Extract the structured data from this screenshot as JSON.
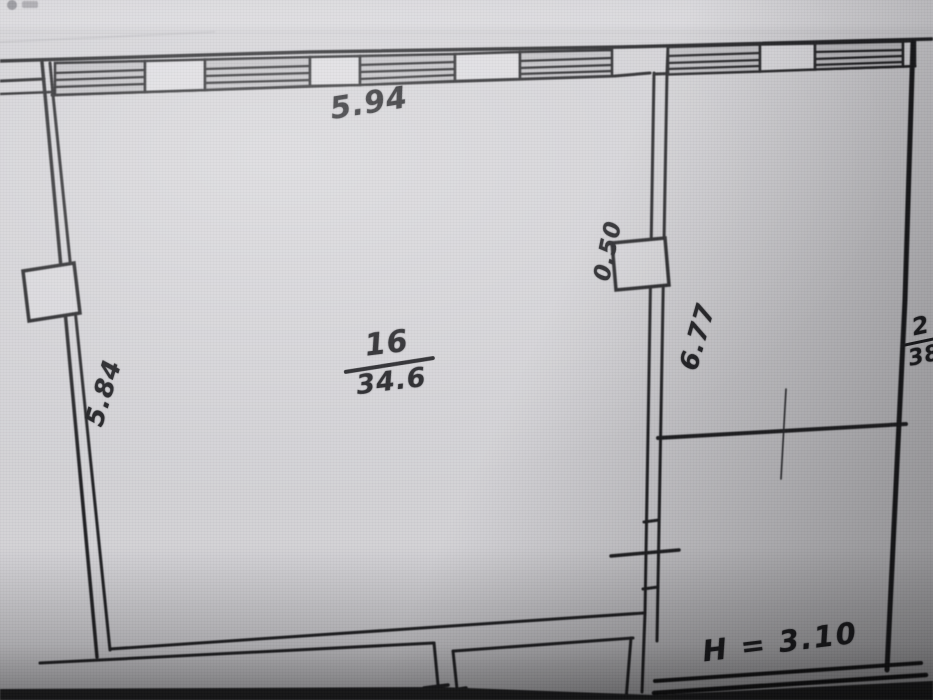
{
  "plan": {
    "room": {
      "number": "16",
      "area": "34.6"
    },
    "dims": {
      "top_width": "5.94",
      "left_height": "5.84",
      "right_height": "6.77",
      "opening_width": "0.50"
    },
    "adjacent_room": {
      "number": "2",
      "area": "38"
    },
    "note_height": "H = 3.10"
  },
  "colors": {
    "paper": "#d3d2d6",
    "ink": "#1f1f22",
    "shadow": "#222224"
  }
}
